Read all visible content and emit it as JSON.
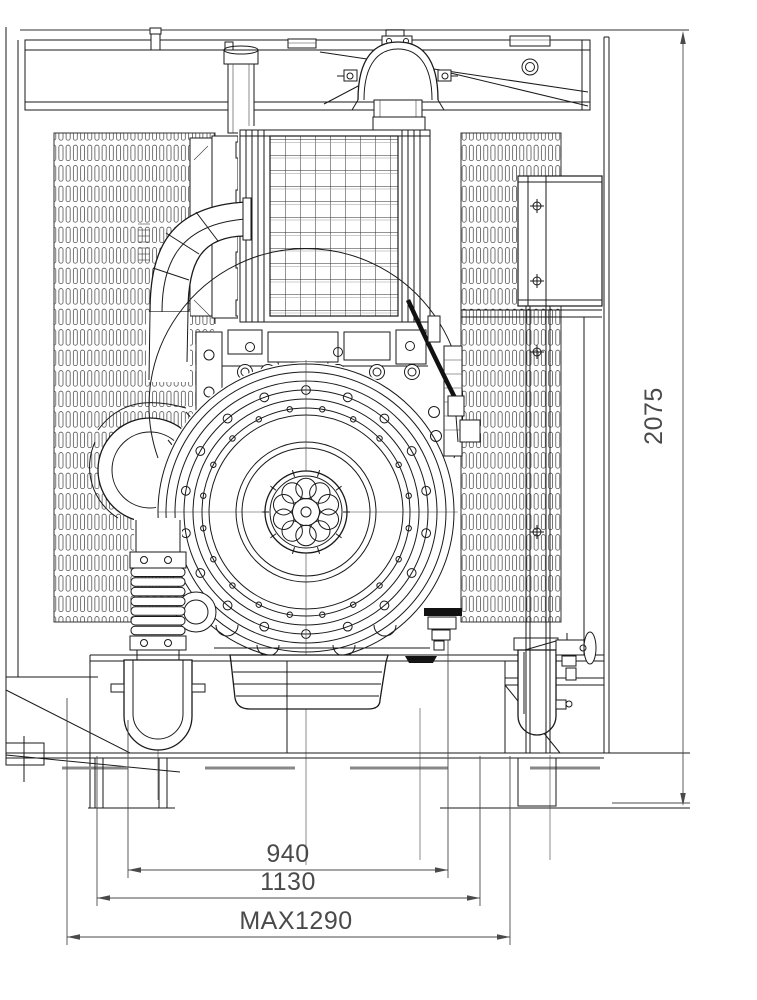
{
  "drawing": {
    "description": "front-view engineering drawing of an engine generator set with dimension annotations",
    "background_color": "#ffffff",
    "line_color": "#1a1a1a",
    "dimension_color": "#4a4a4a"
  },
  "annotations": {
    "bottom_dimensions": [
      {
        "label": "940"
      },
      {
        "label": "1130"
      },
      {
        "label": "MAX1290"
      }
    ],
    "right_dimension": {
      "label": "2075"
    }
  }
}
